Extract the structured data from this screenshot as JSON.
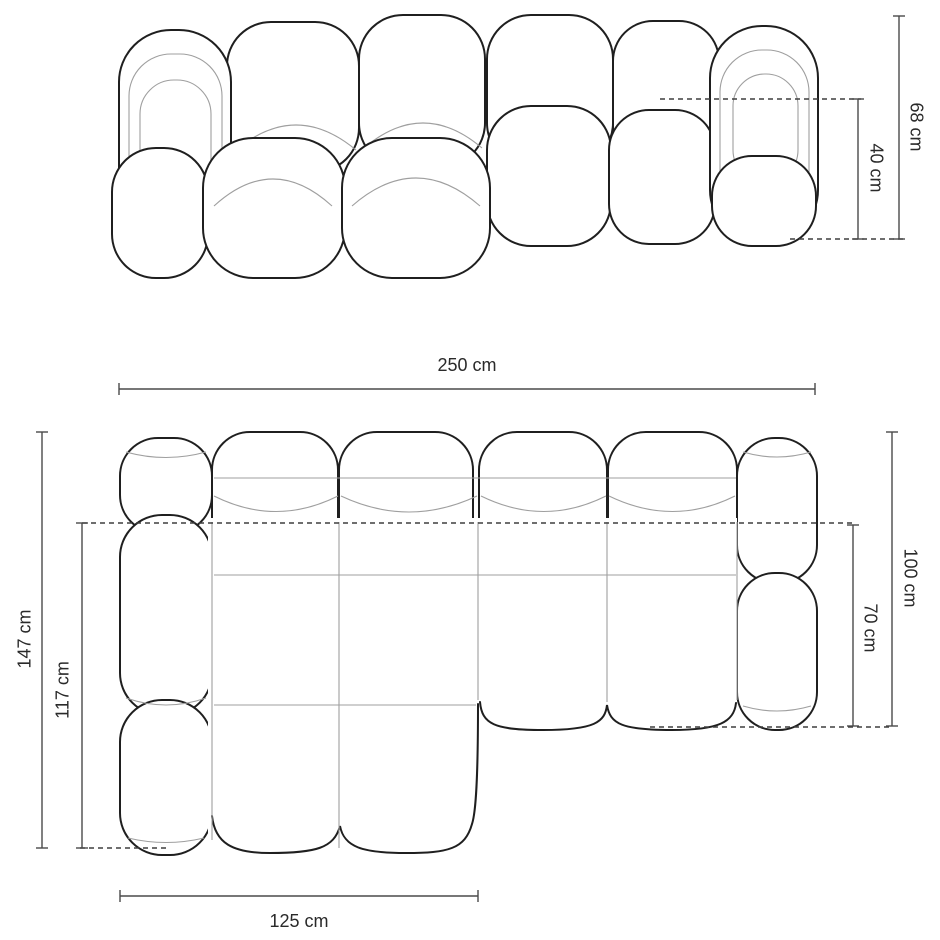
{
  "diagram": {
    "subject": "modular corner sofa dimension drawing",
    "views": {
      "front_elevation": "front elevation",
      "top_plan": "top plan"
    },
    "dimensions": {
      "total_height": {
        "label": "68 cm",
        "value": 68,
        "unit": "cm"
      },
      "seat_height": {
        "label": "40 cm",
        "value": 40,
        "unit": "cm"
      },
      "total_width": {
        "label": "250 cm",
        "value": 250,
        "unit": "cm"
      },
      "total_depth": {
        "label": "147 cm",
        "value": 147,
        "unit": "cm"
      },
      "chaise_inner_depth": {
        "label": "117 cm",
        "value": 117,
        "unit": "cm"
      },
      "body_depth": {
        "label": "100 cm",
        "value": 100,
        "unit": "cm"
      },
      "seat_depth": {
        "label": "70 cm",
        "value": 70,
        "unit": "cm"
      },
      "chaise_width": {
        "label": "125 cm",
        "value": 125,
        "unit": "cm"
      }
    },
    "colors": {
      "outline": "#1f1f1f",
      "seam": "#9f9f9f",
      "dimension_line": "#4a4a4a",
      "background": "#ffffff"
    }
  }
}
